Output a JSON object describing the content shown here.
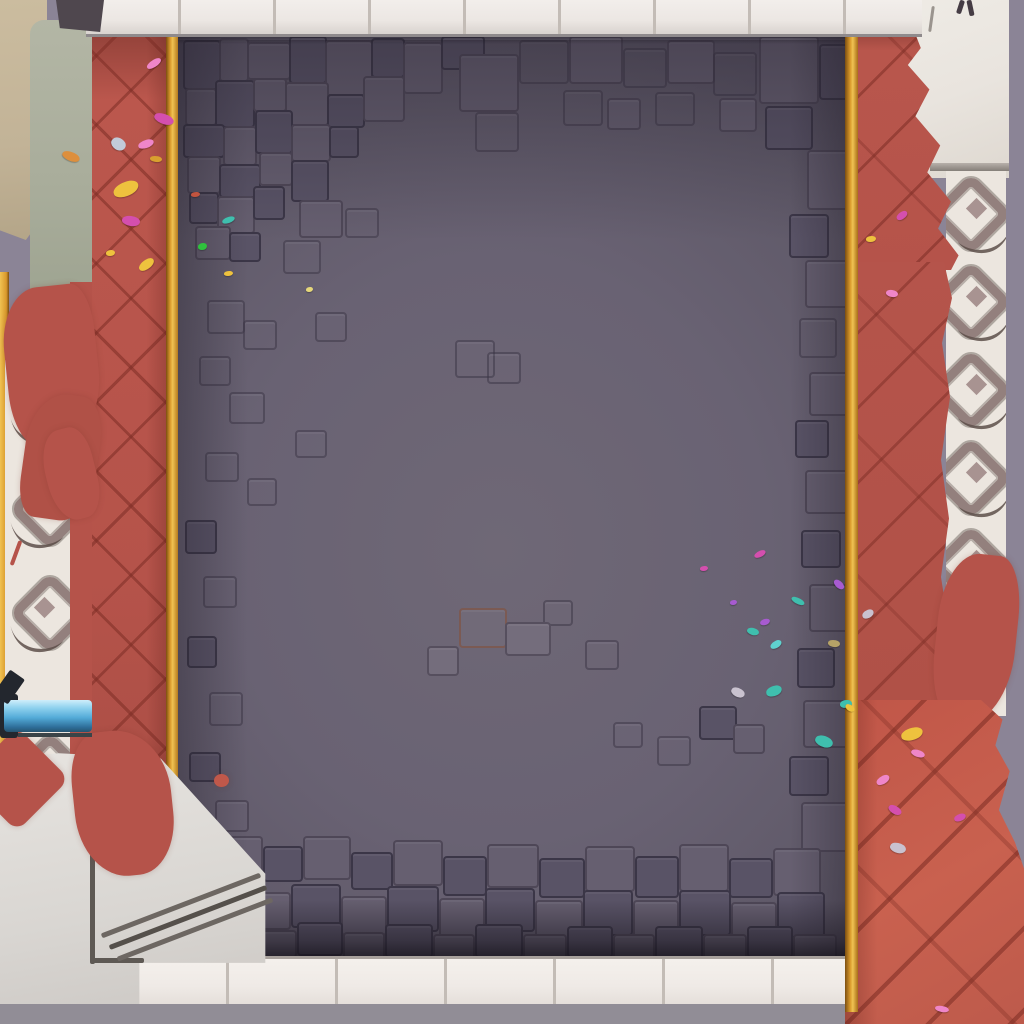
{
  "scene": {
    "title": "Top-down game arena board: gray cobblestone floor framed by red herringbone brick paths with gold trim, white tile borders, ornamental laurel strips, stone steps, a blue pipe and scattered confetti",
    "type": "game-board"
  },
  "palette": {
    "lavender": "#8b8496",
    "grayStrip": "#918d96",
    "tileWhite": "#ece7e3",
    "tileSeam": "#c3bcb6",
    "tileEdge": "#a8a19c",
    "whiteStone": "#e9e4de",
    "laurelBg": "#ece6df",
    "laurelMid": "#93807d",
    "laurelDark": "#5d4f4a",
    "laurelFill": "#a89391",
    "beige": "#c2b397",
    "sage": "#a9ad9b",
    "platform": "#d9d6d2",
    "platformLight": "#e7e4e0",
    "stepLine": "#6d6762",
    "red": "#b5534a",
    "redBright": "#c9614f",
    "redDeep": "#8f4038",
    "gold": "#d9992c",
    "goldLight": "#f0c252",
    "goldDeep": "#7c4e10",
    "floorLight": "#6f6876",
    "floorDark": "#544e5f",
    "stoneLight": "#746d7c",
    "stoneMid": "#665f70",
    "stoneDark": "#595366",
    "pipeLight": "#cfeefb",
    "pipe": "#54abd8",
    "pipeDeep": "#2e6e99",
    "cap": "#23272e"
  },
  "stones": [
    [
      183,
      40,
      34,
      46,
      2
    ],
    [
      219,
      38,
      26,
      40,
      1
    ],
    [
      247,
      42,
      40,
      34,
      1
    ],
    [
      289,
      36,
      34,
      44,
      2
    ],
    [
      325,
      40,
      44,
      52,
      1
    ],
    [
      371,
      38,
      30,
      36,
      2
    ],
    [
      403,
      42,
      36,
      48,
      1
    ],
    [
      441,
      36,
      40,
      30,
      2
    ],
    [
      185,
      88,
      28,
      34,
      1
    ],
    [
      215,
      80,
      36,
      44,
      2
    ],
    [
      253,
      78,
      30,
      30,
      1
    ],
    [
      285,
      82,
      40,
      40,
      1
    ],
    [
      327,
      94,
      34,
      30,
      2
    ],
    [
      363,
      76,
      38,
      42,
      1
    ],
    [
      183,
      124,
      38,
      30,
      2
    ],
    [
      223,
      126,
      30,
      36,
      1
    ],
    [
      255,
      110,
      34,
      40,
      2
    ],
    [
      291,
      124,
      36,
      34,
      1
    ],
    [
      329,
      126,
      26,
      28,
      2
    ],
    [
      187,
      156,
      30,
      34,
      1
    ],
    [
      219,
      164,
      38,
      30,
      2
    ],
    [
      259,
      152,
      30,
      30,
      1
    ],
    [
      291,
      160,
      34,
      38,
      2
    ],
    [
      189,
      192,
      26,
      28,
      2
    ],
    [
      217,
      196,
      34,
      34,
      1
    ],
    [
      253,
      186,
      28,
      30,
      2
    ],
    [
      299,
      200,
      40,
      34,
      1
    ],
    [
      345,
      208,
      30,
      26,
      3
    ],
    [
      195,
      226,
      32,
      30,
      1
    ],
    [
      229,
      232,
      28,
      26,
      2
    ],
    [
      283,
      240,
      34,
      30,
      3
    ],
    [
      207,
      300,
      34,
      30,
      3
    ],
    [
      315,
      312,
      28,
      26,
      3
    ],
    [
      243,
      320,
      30,
      26,
      3
    ],
    [
      199,
      356,
      28,
      26,
      3
    ],
    [
      229,
      392,
      32,
      28,
      3
    ],
    [
      295,
      430,
      28,
      24,
      3
    ],
    [
      205,
      452,
      30,
      26,
      3
    ],
    [
      247,
      478,
      26,
      24,
      3
    ],
    [
      459,
      54,
      56,
      54,
      1
    ],
    [
      519,
      40,
      46,
      40,
      3
    ],
    [
      569,
      36,
      50,
      44,
      1
    ],
    [
      623,
      48,
      40,
      36,
      3
    ],
    [
      667,
      40,
      44,
      40,
      1
    ],
    [
      713,
      52,
      40,
      40,
      3
    ],
    [
      759,
      36,
      56,
      64,
      1
    ],
    [
      819,
      44,
      26,
      52,
      2
    ],
    [
      475,
      112,
      40,
      36,
      3
    ],
    [
      563,
      90,
      36,
      32,
      3
    ],
    [
      607,
      98,
      30,
      28,
      1
    ],
    [
      655,
      92,
      36,
      30,
      3
    ],
    [
      719,
      98,
      34,
      30,
      1
    ],
    [
      765,
      106,
      44,
      40,
      2
    ],
    [
      807,
      150,
      38,
      56,
      1
    ],
    [
      789,
      214,
      36,
      40,
      2
    ],
    [
      805,
      260,
      40,
      44,
      1
    ],
    [
      799,
      318,
      34,
      36,
      3
    ],
    [
      809,
      372,
      36,
      40,
      1
    ],
    [
      795,
      420,
      30,
      34,
      2
    ],
    [
      805,
      470,
      40,
      40,
      1
    ],
    [
      801,
      530,
      36,
      34,
      2
    ],
    [
      809,
      584,
      36,
      44,
      1
    ],
    [
      797,
      648,
      34,
      36,
      2
    ],
    [
      803,
      700,
      42,
      44,
      1
    ],
    [
      789,
      756,
      36,
      36,
      2
    ],
    [
      801,
      802,
      44,
      46,
      1
    ],
    [
      185,
      520,
      28,
      30,
      2
    ],
    [
      203,
      576,
      30,
      28,
      3
    ],
    [
      187,
      636,
      26,
      28,
      2
    ],
    [
      209,
      692,
      30,
      30,
      3
    ],
    [
      189,
      752,
      28,
      26,
      2
    ],
    [
      215,
      800,
      30,
      28,
      1
    ],
    [
      455,
      340,
      36,
      34,
      3
    ],
    [
      487,
      352,
      30,
      28,
      3
    ],
    [
      543,
      600,
      26,
      22,
      3
    ],
    [
      459,
      608,
      44,
      36,
      5
    ],
    [
      505,
      622,
      42,
      30,
      0
    ],
    [
      427,
      646,
      28,
      26,
      0
    ],
    [
      585,
      640,
      30,
      26,
      3
    ],
    [
      613,
      722,
      26,
      22,
      3
    ],
    [
      657,
      736,
      30,
      26,
      3
    ],
    [
      699,
      706,
      34,
      30,
      2
    ],
    [
      733,
      724,
      28,
      26,
      1
    ],
    [
      219,
      836,
      40,
      36,
      1
    ],
    [
      263,
      846,
      36,
      32,
      2
    ],
    [
      303,
      836,
      44,
      40,
      1
    ],
    [
      351,
      852,
      38,
      34,
      2
    ],
    [
      393,
      840,
      46,
      42,
      1
    ],
    [
      443,
      856,
      40,
      36,
      2
    ],
    [
      487,
      844,
      48,
      40,
      1
    ],
    [
      539,
      858,
      42,
      36,
      2
    ],
    [
      585,
      846,
      46,
      42,
      1
    ],
    [
      635,
      856,
      40,
      38,
      2
    ],
    [
      679,
      844,
      46,
      44,
      1
    ],
    [
      729,
      858,
      40,
      36,
      2
    ],
    [
      773,
      848,
      44,
      44,
      1
    ],
    [
      199,
      884,
      44,
      38,
      2
    ],
    [
      247,
      892,
      40,
      34,
      1
    ],
    [
      291,
      884,
      46,
      40,
      2
    ],
    [
      341,
      896,
      42,
      36,
      1
    ],
    [
      387,
      886,
      48,
      42,
      2
    ],
    [
      439,
      898,
      42,
      38,
      1
    ],
    [
      485,
      888,
      46,
      40,
      2
    ],
    [
      535,
      900,
      44,
      36,
      1
    ],
    [
      583,
      890,
      46,
      42,
      2
    ],
    [
      633,
      900,
      42,
      38,
      1
    ],
    [
      679,
      890,
      48,
      42,
      2
    ],
    [
      731,
      902,
      42,
      36,
      1
    ],
    [
      777,
      892,
      44,
      42,
      2
    ],
    [
      215,
      924,
      38,
      28,
      2
    ],
    [
      257,
      930,
      36,
      24,
      1
    ],
    [
      297,
      922,
      42,
      30,
      2
    ],
    [
      343,
      932,
      38,
      26,
      1
    ],
    [
      385,
      924,
      44,
      30,
      2
    ],
    [
      433,
      934,
      38,
      26,
      1
    ],
    [
      475,
      924,
      44,
      30,
      2
    ],
    [
      523,
      934,
      40,
      26,
      1
    ],
    [
      567,
      926,
      42,
      28,
      2
    ],
    [
      613,
      934,
      38,
      26,
      1
    ],
    [
      655,
      926,
      44,
      30,
      2
    ],
    [
      703,
      934,
      40,
      26,
      1
    ],
    [
      747,
      926,
      42,
      28,
      2
    ],
    [
      793,
      934,
      40,
      26,
      1
    ]
  ],
  "splashes": [
    [
      6,
      286,
      92,
      160,
      -6,
      "42% 22% 52% 30%/38% 30% 45% 35%",
      "#b5534a"
    ],
    [
      24,
      394,
      74,
      126,
      8,
      "50% 32% 42% 24%/42% 35% 40% 30%",
      "#b05147"
    ],
    [
      46,
      428,
      50,
      92,
      -14,
      "45% 35% 40% 45%",
      "#b5534a"
    ],
    [
      936,
      554,
      80,
      170,
      6,
      "45% 30% 55% 35%/40% 35% 45% 40%",
      "#b5534a"
    ]
  ],
  "platform_splashes": [
    [
      -20,
      742,
      74,
      74,
      45,
      "12px",
      "#b5534a"
    ],
    [
      74,
      730,
      98,
      146,
      -6,
      "30% 55% 40% 50%/35% 45% 40% 45%",
      "#b5534a"
    ],
    [
      214,
      774,
      15,
      13,
      0,
      "50%",
      "#c0584a"
    ]
  ],
  "steps": [
    [
      90,
      844,
      5,
      120,
      0,
      "#5e5954"
    ],
    [
      90,
      958,
      54,
      5,
      0,
      "#5e5954"
    ],
    [
      96,
      903,
      170,
      5,
      -21,
      "#6d6762"
    ],
    [
      104,
      915,
      168,
      5,
      -21,
      "#55504b"
    ],
    [
      112,
      927,
      166,
      5,
      -21,
      "#6d6762"
    ]
  ],
  "marks": [
    [
      958,
      0,
      5,
      14,
      18,
      "#453c44"
    ],
    [
      968,
      0,
      5,
      16,
      -12,
      "#453c44"
    ],
    [
      930,
      6,
      3,
      26,
      8,
      "#9a948e"
    ],
    [
      0,
      672,
      18,
      30,
      35,
      "#23272e"
    ],
    [
      14,
      540,
      4,
      26,
      20,
      "#b5534a"
    ]
  ],
  "laurels": {
    "left": {
      "x": 2,
      "ys": [
        8,
        112,
        216,
        376
      ],
      "mirror": false
    },
    "right": {
      "x": -6,
      "ys": [
        6,
        94,
        182,
        270,
        358,
        446
      ],
      "mirror": true
    }
  },
  "confetti": [
    [
      146,
      60,
      16,
      7,
      -30,
      "#ef86c9"
    ],
    [
      154,
      114,
      20,
      10,
      24,
      "#d44fae"
    ],
    [
      138,
      140,
      16,
      8,
      -15,
      "#ef86c9"
    ],
    [
      111,
      138,
      15,
      12,
      45,
      "#c2cbd8"
    ],
    [
      150,
      156,
      12,
      6,
      10,
      "#d9a02f"
    ],
    [
      113,
      182,
      26,
      14,
      -18,
      "#eec23e"
    ],
    [
      122,
      216,
      18,
      10,
      14,
      "#d44fae"
    ],
    [
      106,
      250,
      9,
      6,
      0,
      "#eec23e"
    ],
    [
      138,
      260,
      17,
      9,
      -32,
      "#eec23e"
    ],
    [
      62,
      152,
      18,
      9,
      26,
      "#dd8f3d"
    ],
    [
      191,
      192,
      9,
      5,
      0,
      "#c2543f"
    ],
    [
      222,
      217,
      13,
      6,
      -16,
      "#3fbfae"
    ],
    [
      198,
      243,
      9,
      7,
      0,
      "#2fc13d"
    ],
    [
      224,
      271,
      9,
      5,
      0,
      "#eec23e"
    ],
    [
      306,
      287,
      7,
      5,
      0,
      "#e6d87a"
    ],
    [
      754,
      551,
      12,
      6,
      -22,
      "#d44fae"
    ],
    [
      833,
      581,
      12,
      7,
      48,
      "#a75bd0"
    ],
    [
      791,
      598,
      14,
      6,
      30,
      "#3fbfae"
    ],
    [
      760,
      619,
      10,
      6,
      -12,
      "#a75bd0"
    ],
    [
      747,
      628,
      12,
      7,
      20,
      "#3fbfae"
    ],
    [
      770,
      641,
      12,
      7,
      -26,
      "#5fd2cf"
    ],
    [
      828,
      640,
      12,
      7,
      12,
      "#b5a267"
    ],
    [
      731,
      688,
      14,
      9,
      32,
      "#c9c2cf"
    ],
    [
      766,
      686,
      16,
      10,
      -14,
      "#3fbfae"
    ],
    [
      815,
      736,
      18,
      11,
      26,
      "#3fbfae"
    ],
    [
      840,
      700,
      12,
      8,
      0,
      "#3fbfae"
    ],
    [
      845,
      705,
      10,
      6,
      40,
      "#eec23e"
    ],
    [
      862,
      610,
      12,
      8,
      -22,
      "#c9c2cf"
    ],
    [
      700,
      566,
      8,
      5,
      0,
      "#d44fae"
    ],
    [
      730,
      600,
      7,
      5,
      0,
      "#a75bd0"
    ],
    [
      896,
      212,
      12,
      7,
      -30,
      "#d44fae"
    ],
    [
      886,
      290,
      12,
      7,
      16,
      "#ef86c9"
    ],
    [
      866,
      236,
      10,
      6,
      0,
      "#eec23e"
    ],
    [
      901,
      728,
      22,
      12,
      -12,
      "#eec23e"
    ],
    [
      911,
      750,
      14,
      7,
      22,
      "#ef86c9"
    ],
    [
      876,
      776,
      14,
      8,
      -26,
      "#ef86c9"
    ],
    [
      888,
      806,
      14,
      8,
      36,
      "#d44fae"
    ],
    [
      954,
      814,
      12,
      7,
      -16,
      "#d44fae"
    ],
    [
      890,
      843,
      16,
      10,
      22,
      "#c9c2cf"
    ],
    [
      935,
      1006,
      14,
      6,
      14,
      "#ef86c9"
    ]
  ]
}
